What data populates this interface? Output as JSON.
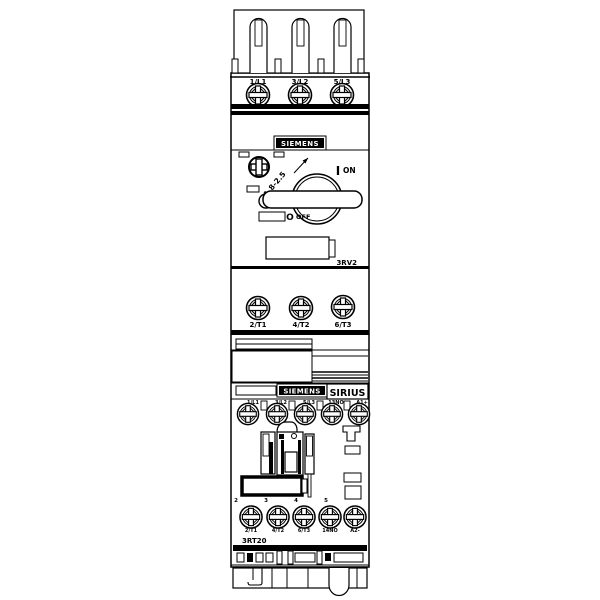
{
  "drawing": {
    "breaker": {
      "brand": "SIEMENS",
      "model": "3RV2",
      "dial_range": "1.8-2.5",
      "on_symbol": "I",
      "on_label": "ON",
      "off_symbol": "O",
      "off_label": "OFF",
      "line_terminals": [
        "1/L1",
        "3/L2",
        "5/L3"
      ],
      "load_terminals": [
        "2/T1",
        "4/T2",
        "6/T3"
      ]
    },
    "contactor": {
      "brand": "SIEMENS",
      "series": "SIRIUS",
      "model": "3RT20",
      "line_terminals": [
        "1/L1",
        "3/L2",
        "5/L3",
        "13NO",
        "A1+"
      ],
      "load_terminals": [
        "2/T1",
        "4/T2",
        "6/T3",
        "14NO",
        "A2-"
      ],
      "pole_numbers": [
        "2",
        "3",
        "4",
        "5"
      ]
    },
    "colors": {
      "line": "#000000",
      "background": "#ffffff"
    }
  }
}
